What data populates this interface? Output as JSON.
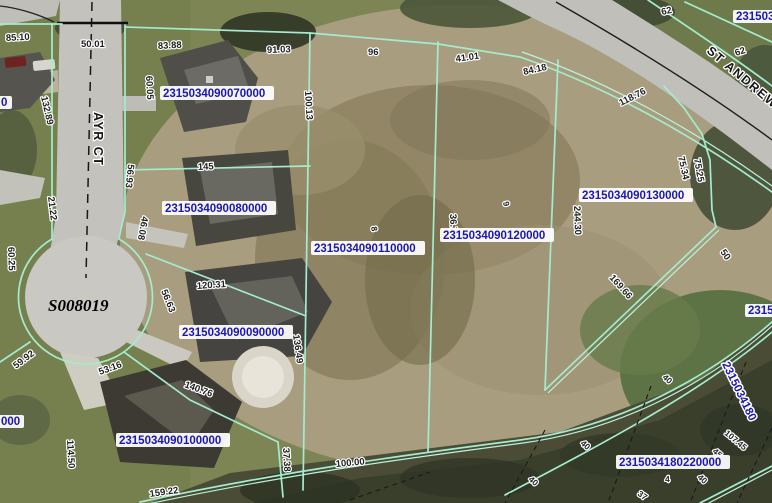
{
  "map_overlay": {
    "streets": {
      "ayr_ct": "AYR CT",
      "st_andrews": "ST ANDREW",
      "survey_id": "S008019"
    },
    "parcel_labels": [
      {
        "key": "p070000",
        "text": "2315034090070000"
      },
      {
        "key": "p080000",
        "text": "2315034090080000"
      },
      {
        "key": "p110000",
        "text": "2315034090110000"
      },
      {
        "key": "p120000",
        "text": "2315034090120000"
      },
      {
        "key": "p130000",
        "text": "2315034090130000"
      },
      {
        "key": "p090000",
        "text": "2315034090090000"
      },
      {
        "key": "p100000",
        "text": "2315034090100000"
      },
      {
        "key": "p180220000",
        "text": "2315034180220000"
      }
    ],
    "partial_parcel_labels": [
      {
        "pos": "top-right",
        "text": "231503"
      },
      {
        "pos": "mid-right",
        "text": "2315"
      },
      {
        "pos": "right-rotated",
        "text": "2315034180"
      },
      {
        "pos": "left-upper",
        "text": "0"
      },
      {
        "pos": "left-lower",
        "text": "000"
      }
    ],
    "dimension_labels": [
      {
        "text": "85.10"
      },
      {
        "text": "50.01"
      },
      {
        "text": "83.88"
      },
      {
        "text": "91.03"
      },
      {
        "text": "96"
      },
      {
        "text": "41.01"
      },
      {
        "text": "62"
      },
      {
        "text": "62"
      },
      {
        "text": "84.18"
      },
      {
        "text": "118.76"
      },
      {
        "text": "100.13"
      },
      {
        "text": "60.05"
      },
      {
        "text": "132.89"
      },
      {
        "text": "21.22"
      },
      {
        "text": "56.93"
      },
      {
        "text": "46.08"
      },
      {
        "text": "60.25"
      },
      {
        "text": "59.92"
      },
      {
        "text": "53.16"
      },
      {
        "text": "56.63"
      },
      {
        "text": "120.31"
      },
      {
        "text": "136.49"
      },
      {
        "text": "140.76"
      },
      {
        "text": "114.50"
      },
      {
        "text": "37.38"
      },
      {
        "text": "100.00"
      },
      {
        "text": "159.22"
      },
      {
        "text": "244.30"
      },
      {
        "text": "75.34"
      },
      {
        "text": "75.25"
      },
      {
        "text": "169.66"
      },
      {
        "text": "50"
      },
      {
        "text": "145"
      },
      {
        "text": "36.70"
      },
      {
        "text": "8"
      },
      {
        "text": "9"
      },
      {
        "text": "40"
      },
      {
        "text": "40"
      },
      {
        "text": "40"
      },
      {
        "text": "40"
      },
      {
        "text": "107.45"
      },
      {
        "text": "45"
      },
      {
        "text": "4"
      },
      {
        "text": "37"
      }
    ],
    "colors": {
      "parcel_line": "#a4eccf",
      "parcel_label_text": "#1c17ad",
      "parcel_label_bg": "#ffffff",
      "dimension_text": "#1f1f1f",
      "road": "#c3c2bd"
    }
  }
}
